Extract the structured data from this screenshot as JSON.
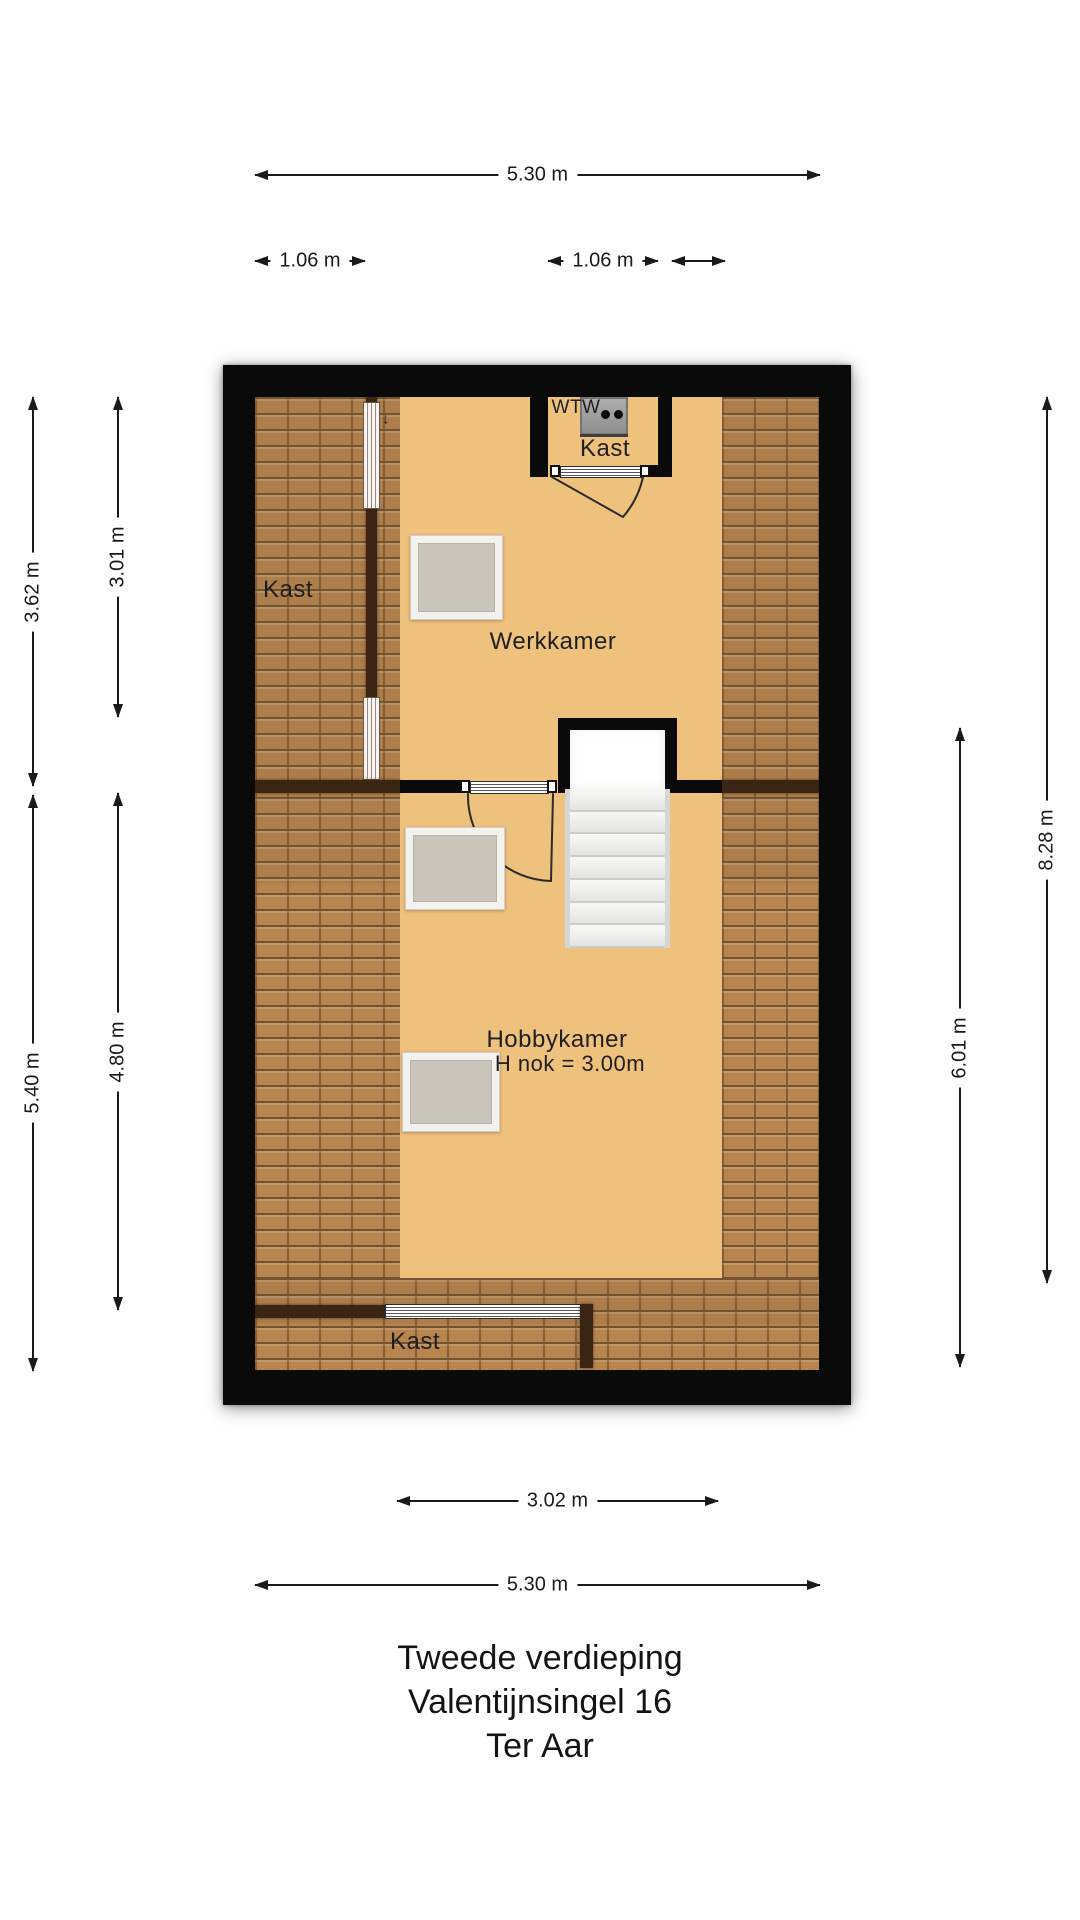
{
  "floorplan": {
    "rooms": {
      "werkkamer": "Werkkamer",
      "hobbykamer": "Hobbykamer",
      "hobbykamer_note": "H nok = 3.00m",
      "kast_left": "Kast",
      "kast_top": "Kast",
      "kast_bottom": "Kast",
      "wtw": "WTW",
      "door_swing_mark": "↓"
    },
    "dimensions": {
      "top_total": "5.30 m",
      "top_closet_left": "1.06 m",
      "top_closet_center": "1.06 m",
      "left_upper_outer": "3.62 m",
      "left_upper_inner": "3.01 m",
      "left_lower_outer": "5.40 m",
      "left_lower_inner": "4.80 m",
      "right_outer": "8.28 m",
      "right_inner": "6.01 m",
      "bottom_room": "3.02 m",
      "bottom_total": "5.30 m"
    },
    "caption": {
      "line1": "Tweede verdieping",
      "line2": "Valentijnsingel 16",
      "line3": "Ter Aar"
    },
    "colors": {
      "floor": "#eec17d",
      "roof_tiles": "#b8854f",
      "tile_grout": "#6f5130",
      "wall": "#0a0a0a",
      "knee_wall": "#3a2413",
      "skylight_pane": "#c9c5ba",
      "stair_tread": "#ececec",
      "wtw_unit": "#9b9b9b",
      "dimension_line": "#1a1a1a"
    }
  }
}
